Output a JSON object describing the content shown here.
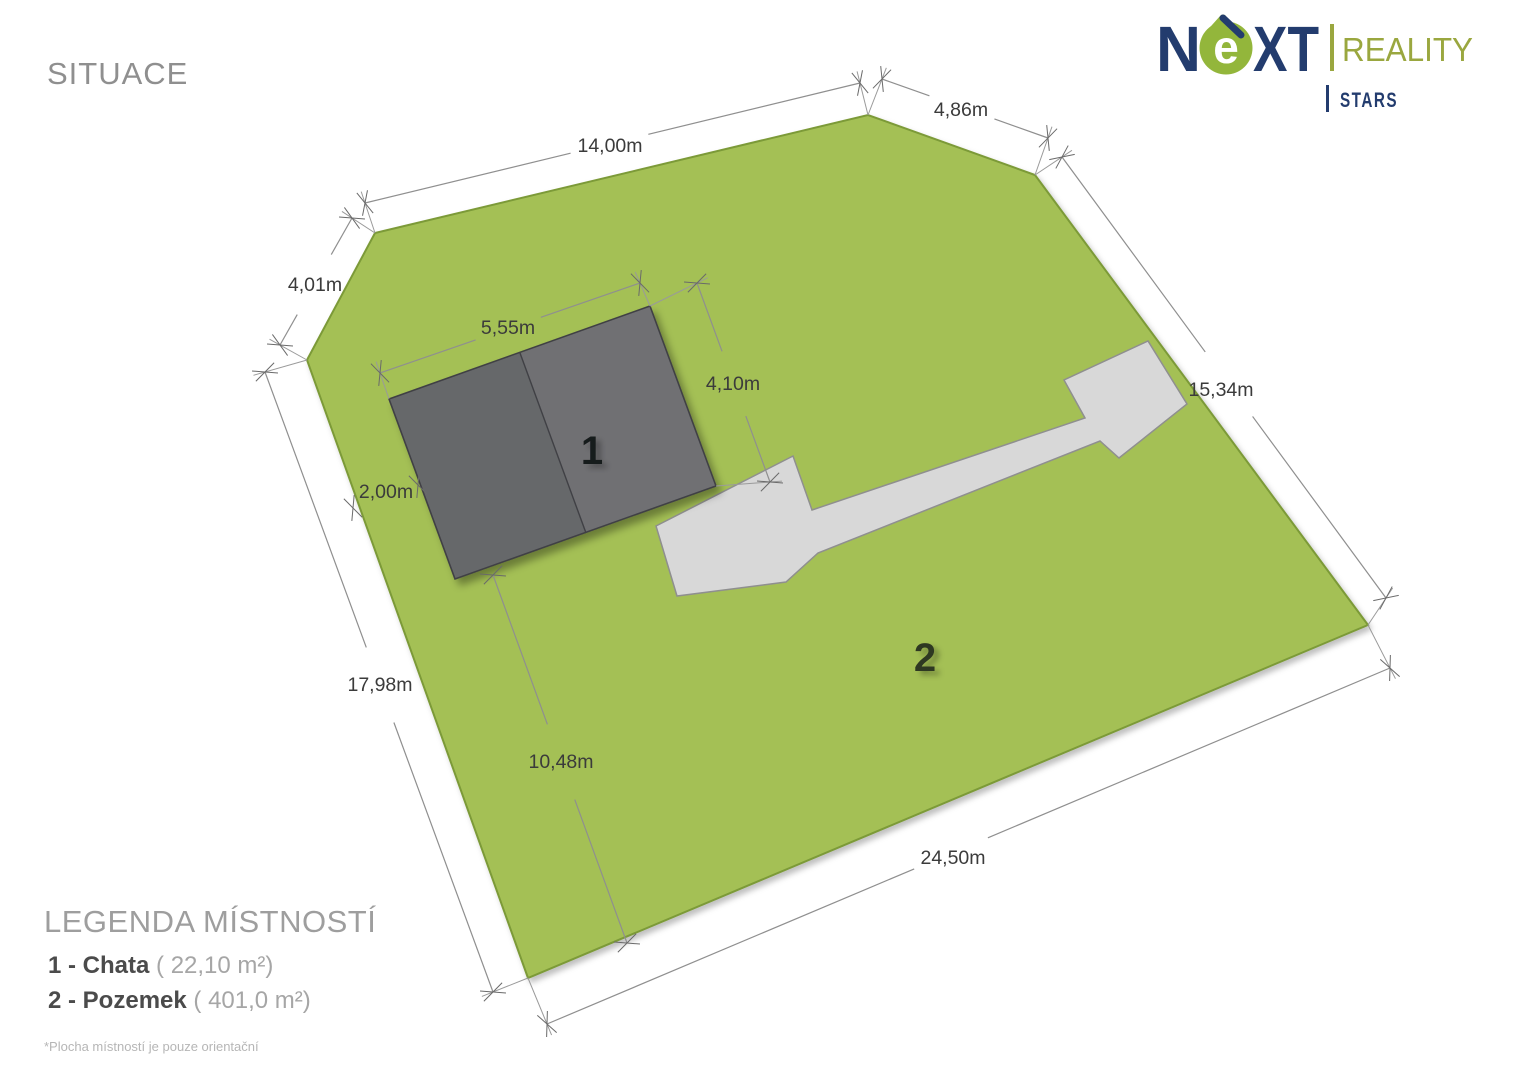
{
  "title": "SITUACE",
  "logo": {
    "n": "N",
    "e": "e",
    "xt": "XT",
    "reality": "REALITY",
    "stars": "STARS",
    "navy": "#233c6e",
    "green": "#93b63b",
    "olive": "#9aa73f"
  },
  "legend": {
    "title": "LEGENDA MÍSTNOSTÍ",
    "items": [
      {
        "bold": "1 - Chata",
        "area": " ( 22,10 m²)"
      },
      {
        "bold": "2 - Pozemek",
        "area": " ( 401,0 m²)"
      }
    ],
    "footnote": "*Plocha místností je pouze orientační"
  },
  "plan": {
    "colors": {
      "land_fill": "#a4c055",
      "land_border": "#7c9a38",
      "building_left": "#66676a",
      "building_right": "#6f7073",
      "building_border": "#404144",
      "path_fill": "#d8d8d8",
      "path_border": "#8f8f8f",
      "dim_line": "#8f8f8f",
      "dim_text": "#3b3b3b",
      "tick": "#6a6a6a",
      "connector": "#9a9a9a",
      "label1_color": "#191a1c",
      "label2_color": "#2e3820"
    },
    "land_polygon": [
      [
        375,
        233
      ],
      [
        868,
        115
      ],
      [
        1035,
        175
      ],
      [
        1368,
        625
      ],
      [
        528,
        978
      ],
      [
        307,
        360
      ]
    ],
    "path_polygon": [
      [
        656,
        526
      ],
      [
        793,
        456
      ],
      [
        812,
        510
      ],
      [
        1085,
        418
      ],
      [
        1064,
        380
      ],
      [
        1148,
        341
      ],
      [
        1187,
        404
      ],
      [
        1119,
        458
      ],
      [
        1100,
        441
      ],
      [
        818,
        553
      ],
      [
        786,
        582
      ],
      [
        677,
        596
      ]
    ],
    "building_polygon": [
      [
        389,
        399
      ],
      [
        650,
        306
      ],
      [
        716,
        486
      ],
      [
        455,
        579
      ]
    ],
    "building_ridge": [
      [
        520,
        353
      ],
      [
        586,
        533
      ]
    ],
    "area_labels": [
      {
        "text": "1",
        "x": 592,
        "y": 464
      },
      {
        "text": "2",
        "x": 925,
        "y": 671
      }
    ],
    "dimensions": [
      {
        "label": "14,00m",
        "x1": 365,
        "y1": 203,
        "x2": 860,
        "y2": 83,
        "lx": 610,
        "ly": 146
      },
      {
        "label": "4,86m",
        "x1": 882,
        "y1": 79,
        "x2": 1048,
        "y2": 138,
        "lx": 961,
        "ly": 110
      },
      {
        "label": "15,34m",
        "x1": 1062,
        "y1": 157,
        "x2": 1386,
        "y2": 598,
        "lx": 1221,
        "ly": 390
      },
      {
        "label": "24,50m",
        "x1": 547,
        "y1": 1024,
        "x2": 1390,
        "y2": 668,
        "lx": 953,
        "ly": 858
      },
      {
        "label": "17,98m",
        "x1": 265,
        "y1": 372,
        "x2": 493,
        "y2": 992,
        "lx": 380,
        "ly": 685
      },
      {
        "label": "4,01m",
        "x1": 352,
        "y1": 218,
        "x2": 280,
        "y2": 345,
        "lx": 315,
        "ly": 285
      },
      {
        "label": "5,55m",
        "x1": 380,
        "y1": 373,
        "x2": 640,
        "y2": 283,
        "lx": 508,
        "ly": 328
      },
      {
        "label": "4,10m",
        "x1": 697,
        "y1": 283,
        "x2": 770,
        "y2": 482,
        "lx": 733,
        "ly": 384
      },
      {
        "label": "2,00m",
        "x1": 353,
        "y1": 508,
        "x2": 418,
        "y2": 485,
        "lx": 386,
        "ly": 492
      },
      {
        "label": "10,48m",
        "x1": 493,
        "y1": 575,
        "x2": 627,
        "y2": 943,
        "lx": 561,
        "ly": 762
      }
    ],
    "connectors": [
      [
        [
          375,
          233
        ],
        [
          365,
          203
        ]
      ],
      [
        [
          375,
          233
        ],
        [
          352,
          218
        ]
      ],
      [
        [
          868,
          115
        ],
        [
          860,
          83
        ]
      ],
      [
        [
          868,
          115
        ],
        [
          882,
          79
        ]
      ],
      [
        [
          1035,
          175
        ],
        [
          1048,
          138
        ]
      ],
      [
        [
          1035,
          175
        ],
        [
          1062,
          157
        ]
      ],
      [
        [
          1368,
          625
        ],
        [
          1386,
          598
        ]
      ],
      [
        [
          1368,
          625
        ],
        [
          1390,
          668
        ]
      ],
      [
        [
          528,
          978
        ],
        [
          493,
          992
        ]
      ],
      [
        [
          528,
          978
        ],
        [
          547,
          1024
        ]
      ],
      [
        [
          307,
          360
        ],
        [
          280,
          345
        ]
      ],
      [
        [
          307,
          360
        ],
        [
          265,
          372
        ]
      ],
      [
        [
          389,
          399
        ],
        [
          380,
          373
        ]
      ],
      [
        [
          650,
          306
        ],
        [
          640,
          283
        ]
      ],
      [
        [
          650,
          306
        ],
        [
          697,
          283
        ]
      ],
      [
        [
          716,
          486
        ],
        [
          770,
          482
        ]
      ]
    ]
  }
}
